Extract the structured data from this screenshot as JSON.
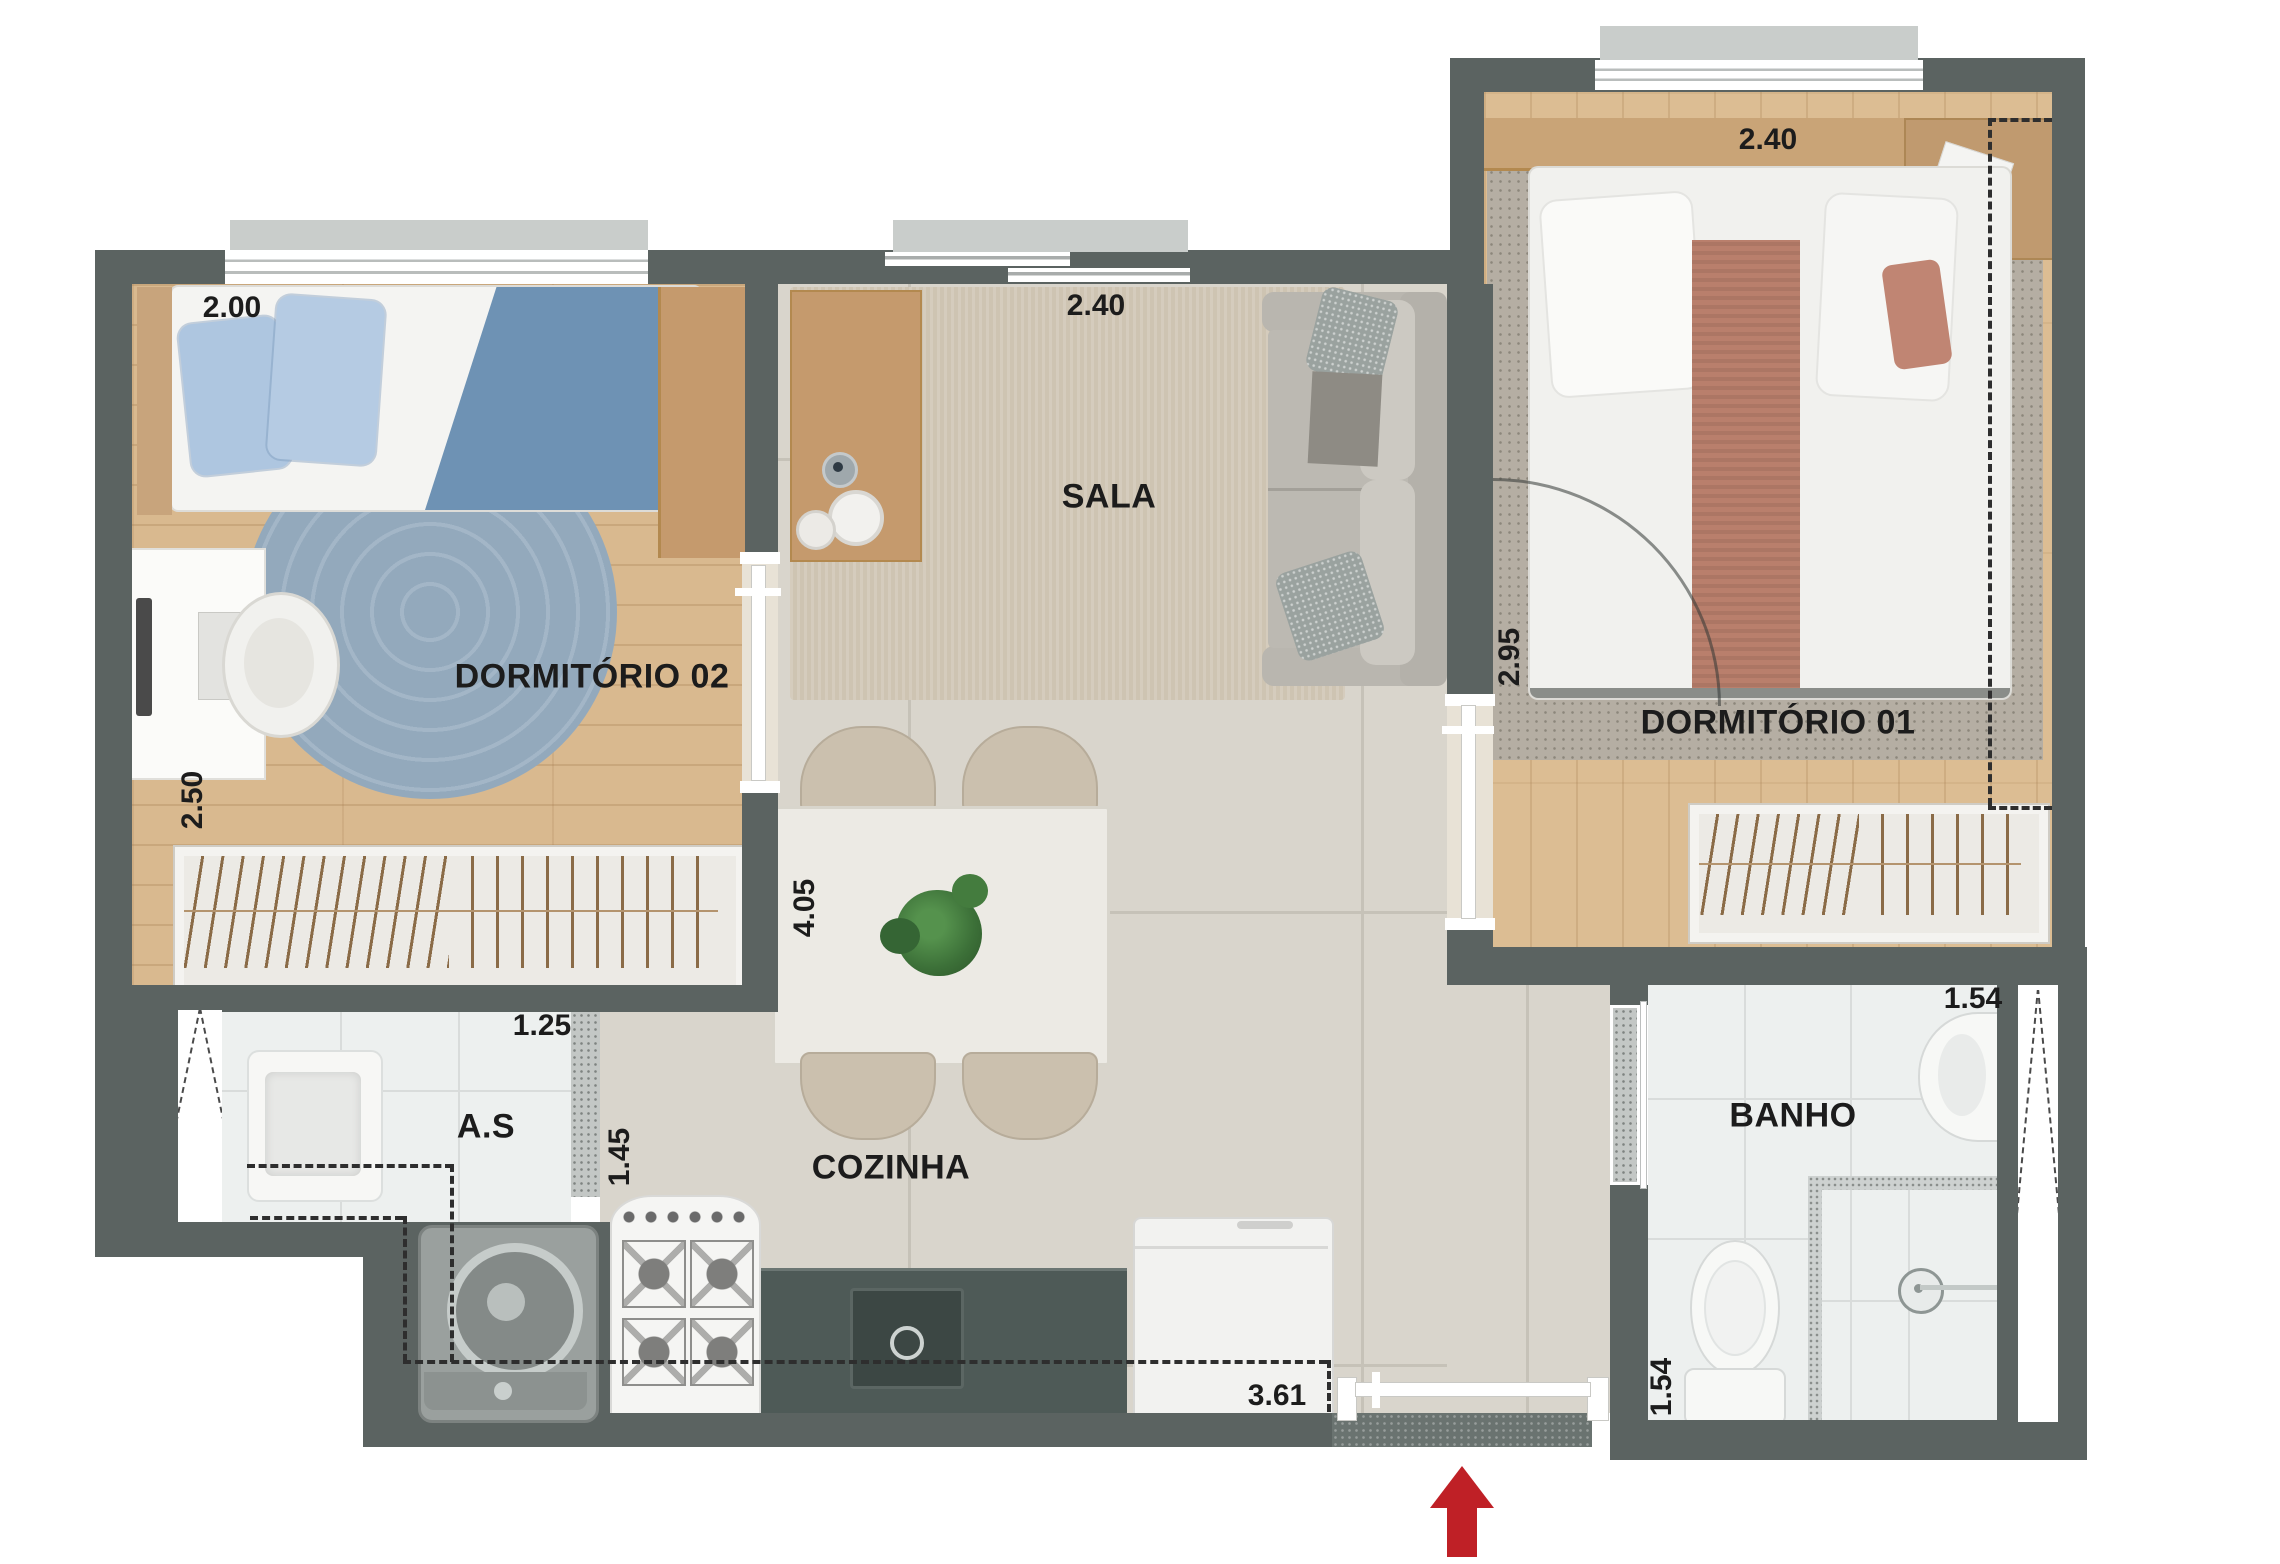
{
  "title": "Floor plan apartment 2 dormitorios",
  "rooms": {
    "dorm02": {
      "label": "DORMITÓRIO 02",
      "dim_top": "2.00",
      "dim_left": "2.50"
    },
    "sala": {
      "label": "SALA",
      "dim_top": "2.40"
    },
    "dorm01": {
      "label": "DORMITÓRIO 01",
      "dim_top": "2.40",
      "dim_left": "2.95"
    },
    "as": {
      "label": "A.S",
      "dim_top": "1.25",
      "dim_right": "1.45"
    },
    "cozinha": {
      "label": "COZINHA",
      "dim_left": "4.05",
      "dim_bottom": "3.61"
    },
    "banho": {
      "label": "BANHO",
      "dim_top": "1.54",
      "dim_left": "1.54"
    }
  },
  "icons": {
    "entrance_arrow": "entrance-arrow-icon"
  },
  "colors": {
    "wall": "#5b6361",
    "wood2": "#d9b98f",
    "wood1": "#dcbd93",
    "tile": "#d9d5cc",
    "tilewhite": "#edf0ef",
    "counter": "#4e5a57",
    "rugblue": "#93a9bc",
    "rugsala": "#cec4b2",
    "rugdorm1": "#b5aea3",
    "bedblue": "#6e92b4",
    "pillowblue": "#aec6e0",
    "terracotta": "#b97f6c",
    "sofa": "#bcb9b2",
    "chairbeige": "#cbc0ae",
    "plant": "#3c7038",
    "arrowred": "#bf2026",
    "slab": "#c9cdcb",
    "label": "#1c1c1c"
  }
}
